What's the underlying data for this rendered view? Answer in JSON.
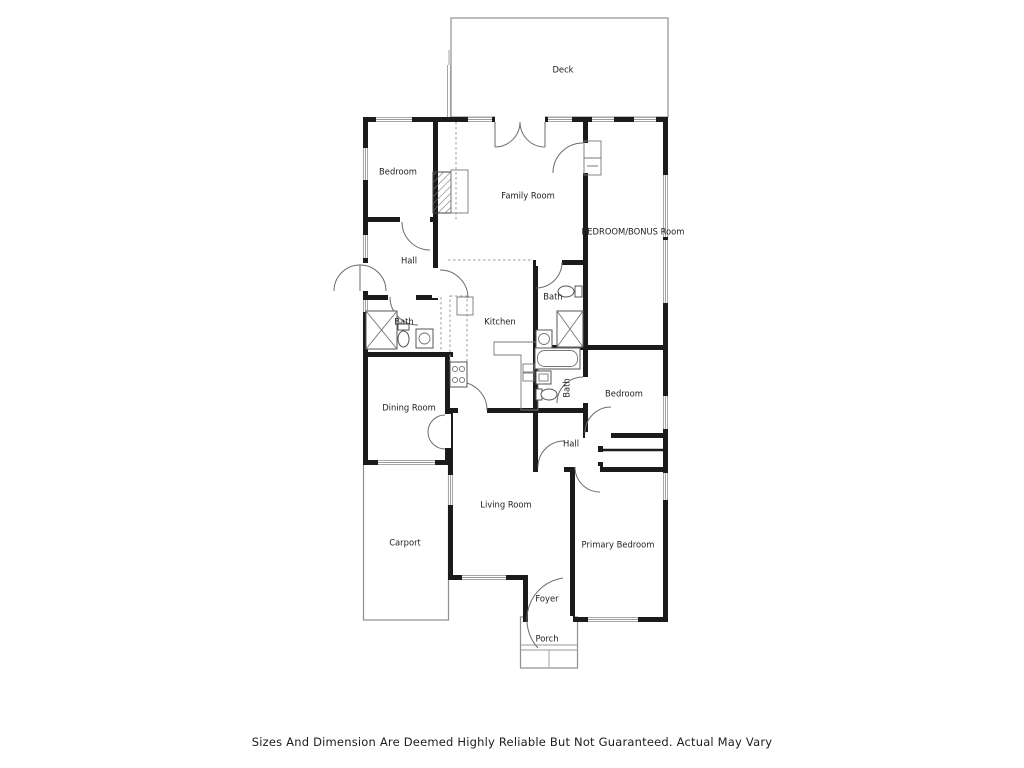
{
  "floorplan": {
    "rooms": [
      {
        "name": "deck",
        "label": "Deck",
        "x": 563,
        "y": 70
      },
      {
        "name": "bedroom-top-left",
        "label": "Bedroom",
        "x": 398,
        "y": 172
      },
      {
        "name": "family-room",
        "label": "Family Room",
        "x": 528,
        "y": 196
      },
      {
        "name": "bedroom-bonus-room",
        "label": "BEDROOM/BONUS Room",
        "x": 633,
        "y": 232
      },
      {
        "name": "hall-upper",
        "label": "Hall",
        "x": 409,
        "y": 261
      },
      {
        "name": "bath-middle-top",
        "label": "Bath",
        "x": 553,
        "y": 297
      },
      {
        "name": "kitchen",
        "label": "Kitchen",
        "x": 500,
        "y": 322
      },
      {
        "name": "bath-left",
        "label": "Bath",
        "x": 404,
        "y": 322
      },
      {
        "name": "dining-room",
        "label": "Dining Room",
        "x": 409,
        "y": 408
      },
      {
        "name": "bedroom-middle-right",
        "label": "Bedroom",
        "x": 624,
        "y": 394
      },
      {
        "name": "bath-ensuite",
        "label": "Bath",
        "x": 567,
        "y": 388,
        "rotate": -90
      },
      {
        "name": "hall-lower",
        "label": "Hall",
        "x": 571,
        "y": 444
      },
      {
        "name": "living-room",
        "label": "Living Room",
        "x": 506,
        "y": 505
      },
      {
        "name": "carport",
        "label": "Carport",
        "x": 405,
        "y": 543
      },
      {
        "name": "primary-bedroom",
        "label": "Primary Bedroom",
        "x": 618,
        "y": 545
      },
      {
        "name": "foyer",
        "label": "Foyer",
        "x": 547,
        "y": 599
      },
      {
        "name": "porch",
        "label": "Porch",
        "x": 547,
        "y": 639
      }
    ],
    "disclaimer": "Sizes And Dimension Are Deemed Highly Reliable But Not Guaranteed. Actual May Vary",
    "colors": {
      "wall": "#1b1b1b",
      "thin_line": "#8f8f8f",
      "text": "#222222",
      "background": "#ffffff"
    }
  }
}
